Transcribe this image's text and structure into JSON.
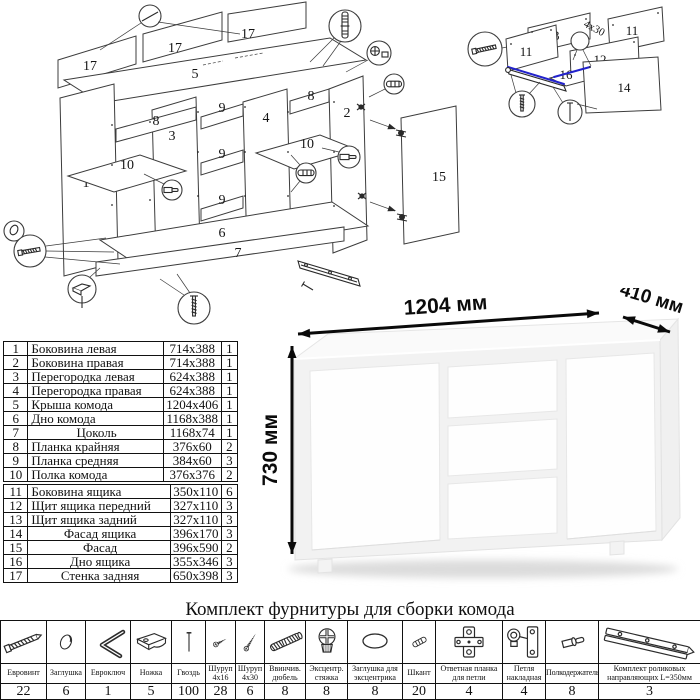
{
  "parts_table": {
    "group1": [
      {
        "no": "1",
        "name": "Боковина левая",
        "size": "714x388",
        "qty": "1"
      },
      {
        "no": "2",
        "name": "Боковина правая",
        "size": "714x388",
        "qty": "1"
      },
      {
        "no": "3",
        "name": "Перегородка левая",
        "size": "624x388",
        "qty": "1"
      },
      {
        "no": "4",
        "name": "Перегородка правая",
        "size": "624x388",
        "qty": "1"
      },
      {
        "no": "5",
        "name": "Крыша комода",
        "size": "1204x406",
        "qty": "1"
      },
      {
        "no": "6",
        "name": "Дно комода",
        "size": "1168x388",
        "qty": "1"
      },
      {
        "no": "7",
        "name": "Цоколь",
        "size": "1168x74",
        "qty": "1"
      },
      {
        "no": "8",
        "name": "Планка крайняя",
        "size": "376x60",
        "qty": "2"
      },
      {
        "no": "9",
        "name": "Планка средняя",
        "size": "384x60",
        "qty": "3"
      },
      {
        "no": "10",
        "name": "Полка комода",
        "size": "376x376",
        "qty": "2"
      }
    ],
    "group2": [
      {
        "no": "11",
        "name": "Боковина ящика",
        "size": "350x110",
        "qty": "6"
      },
      {
        "no": "12",
        "name": "Щит ящика передний",
        "size": "327x110",
        "qty": "3"
      },
      {
        "no": "13",
        "name": "Щит ящика задний",
        "size": "327x110",
        "qty": "3"
      },
      {
        "no": "14",
        "name": "Фасад ящика",
        "size": "396x170",
        "qty": "3"
      },
      {
        "no": "15",
        "name": "Фасад",
        "size": "396x590",
        "qty": "2"
      },
      {
        "no": "16",
        "name": "Дно ящика",
        "size": "355x346",
        "qty": "3"
      },
      {
        "no": "17",
        "name": "Стенка задняя",
        "size": "650x398",
        "qty": "3"
      }
    ]
  },
  "dimensions": {
    "width": "1204 мм",
    "depth": "410 мм",
    "height": "730 мм"
  },
  "main_diagram": {
    "labels": {
      "p1": "1",
      "p2": "2",
      "p3": "3",
      "p4": "4",
      "p5": "5",
      "p6": "6",
      "p7": "7",
      "p8a": "8",
      "p8b": "8",
      "p9a": "9",
      "p9b": "9",
      "p9c": "9",
      "p10a": "10",
      "p10b": "10",
      "p15": "15",
      "p17a": "17",
      "p17b": "17",
      "p17c": "17"
    }
  },
  "drawer_diagram": {
    "labels": {
      "p11a": "11",
      "p11b": "11",
      "p12": "12",
      "p13": "13",
      "p14": "14",
      "p16": "16"
    },
    "screw_note": "4x30",
    "rail_color": "#2323cc"
  },
  "hardware": {
    "title": "Комплект фурнитуры для сборки комода",
    "items": [
      {
        "name": "Евровинт",
        "qty": "22",
        "icon": "euro-screw-icon"
      },
      {
        "name": "Заглушка",
        "qty": "6",
        "icon": "cap-icon"
      },
      {
        "name": "Евроключ",
        "qty": "1",
        "icon": "hex-key-icon"
      },
      {
        "name": "Ножка",
        "qty": "5",
        "icon": "foot-icon"
      },
      {
        "name": "Гвоздь",
        "qty": "100",
        "icon": "nail-icon"
      },
      {
        "name": "Шуруп 4x16",
        "qty": "28",
        "icon": "screw-small-icon"
      },
      {
        "name": "Шуруп 4x30",
        "qty": "6",
        "icon": "screw-large-icon"
      },
      {
        "name": "Ввинчив. дюбель",
        "qty": "8",
        "icon": "threaded-dowel-icon"
      },
      {
        "name": "Эксцентр. стяжка",
        "qty": "8",
        "icon": "cam-lock-icon"
      },
      {
        "name": "Заглушка для эксцентрика",
        "qty": "8",
        "icon": "cam-cap-icon"
      },
      {
        "name": "Шкант",
        "qty": "20",
        "icon": "wood-dowel-icon"
      },
      {
        "name": "Ответная планка для петли",
        "qty": "4",
        "icon": "hinge-plate-icon"
      },
      {
        "name": "Петля накладная",
        "qty": "4",
        "icon": "hinge-icon"
      },
      {
        "name": "Полкодержатель",
        "qty": "8",
        "icon": "shelf-pin-icon"
      },
      {
        "name": "Комплект роликовых направляющих L=350мм",
        "qty": "3",
        "icon": "drawer-slide-icon"
      }
    ]
  }
}
